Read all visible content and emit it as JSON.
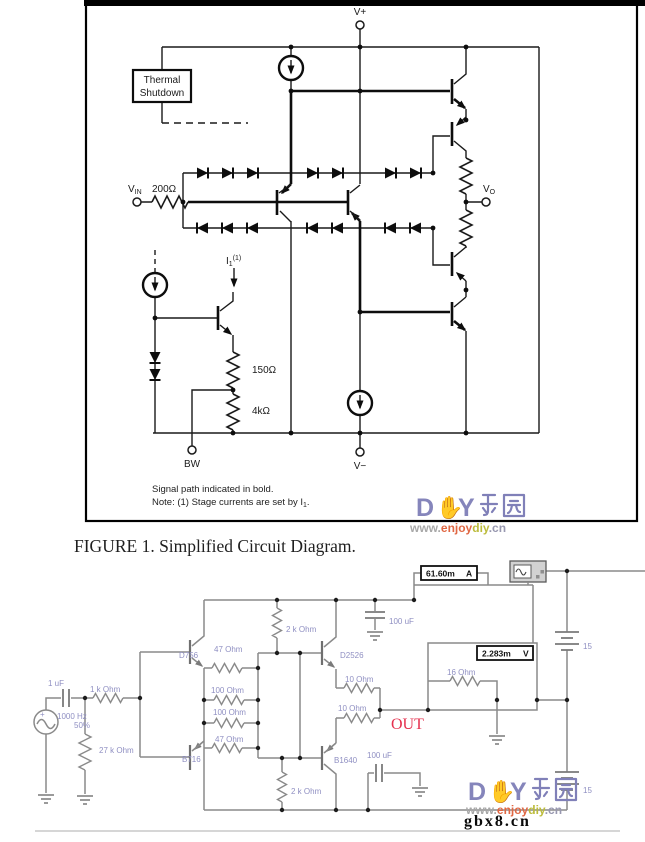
{
  "figure1": {
    "caption": "FIGURE 1. Simplified Circuit Diagram.",
    "thermal_line1": "Thermal",
    "thermal_line2": "Shutdown",
    "v_plus": "V+",
    "v_minus": "V−",
    "vin_base": "V",
    "vin_sub": "IN",
    "r_input": "200Ω",
    "vo_base": "V",
    "vo_sub": "O",
    "bw": "BW",
    "i1_base": "I",
    "i1_sub": "1",
    "i1_sup": "(1)",
    "r_150": "150Ω",
    "r_4k": "4kΩ",
    "note1": "Signal path indicated in bold.",
    "note2_pre": "Note: (1) Stage currents are set by I",
    "note2_sub": "1",
    "note2_post": "."
  },
  "schematic2": {
    "source_plus": "+",
    "source_freq": "1000 Hz",
    "source_duty": "50%",
    "c_in": "1 uF",
    "r_series": "1 k Ohm",
    "r_shunt": "27 k Ohm",
    "q_top_driver": "D756",
    "q_bottom_driver": "B716",
    "r_47_top": "47 Ohm",
    "r_100_top": "100 Ohm",
    "r_100_bottom": "100 Ohm",
    "r_47_bottom": "47 Ohm",
    "r_2k_top": "2 k Ohm",
    "r_2k_bottom": "2 k Ohm",
    "q_out_top": "D2526",
    "q_out_bottom": "B1640",
    "r_10_top": "10 Ohm",
    "r_10_bottom": "10 Ohm",
    "c_supply": "100 uF",
    "c_out": "100 uF",
    "r_load": "16 Ohm",
    "out": "OUT",
    "ammeter_value": "61.60m",
    "ammeter_unit": "A",
    "voltmeter_value": "2.283m",
    "voltmeter_unit": "V",
    "battery_top": "15",
    "battery_bottom": "15"
  },
  "watermark": {
    "d": "D",
    "hand": "✋",
    "y": "Y",
    "cjk": "乐园",
    "www": "www.",
    "enjoy": "enjoy",
    "diy": "diy",
    "cn": ".cn",
    "overlay": "gbx8.cn"
  },
  "colors": {
    "out_red": "#e5304e",
    "label_blue": "#8f8fc2",
    "watermark_purple": "#8585bb"
  }
}
